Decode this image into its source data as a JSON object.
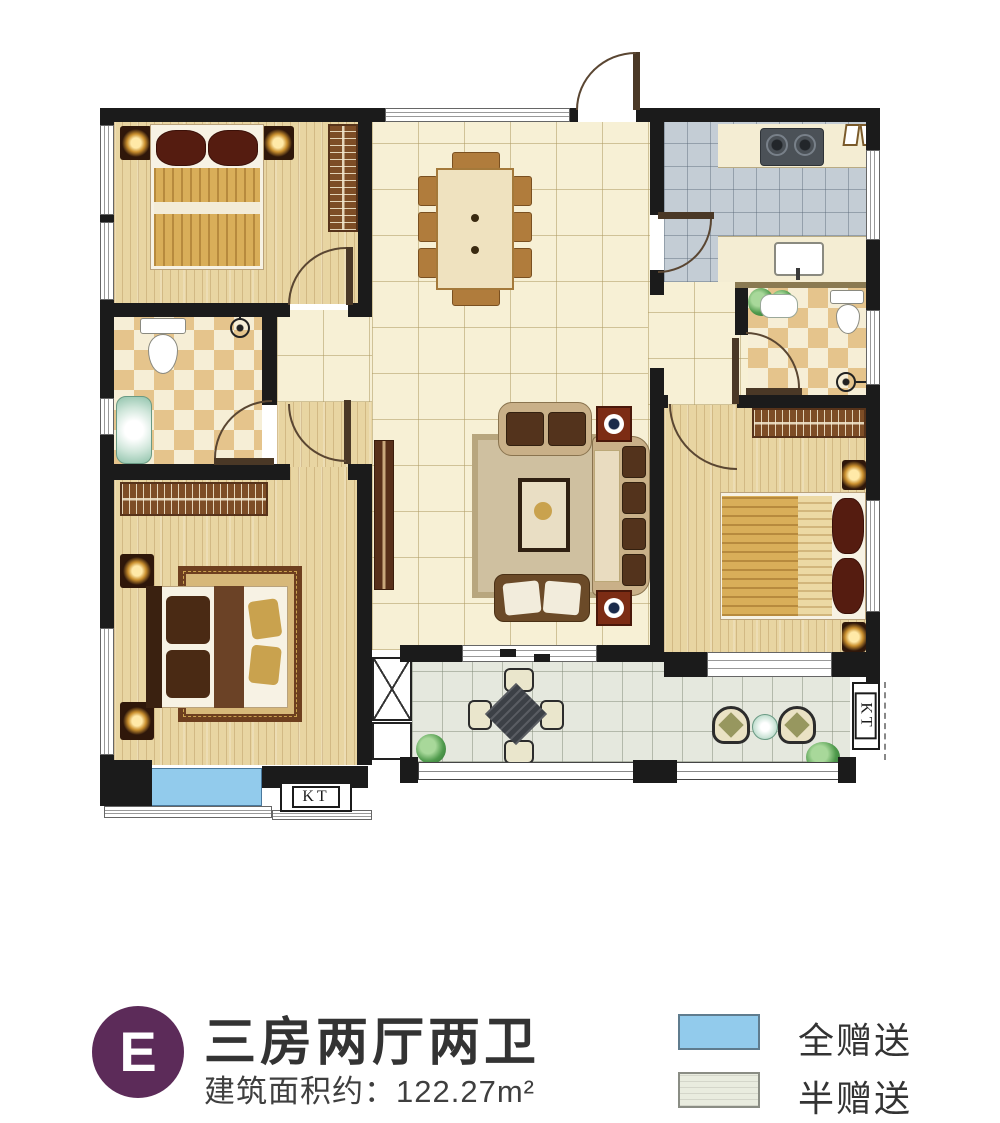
{
  "plan": {
    "ac_unit_label_left": "KT",
    "ac_unit_label_right": "KT",
    "rooms_visible": [
      "bedroom-top-left",
      "bathroom-left",
      "bedroom-bottom-left",
      "dining-area",
      "living-area",
      "kitchen",
      "bathroom-right",
      "bedroom-right",
      "balcony",
      "bay-window"
    ],
    "colors": {
      "wall": "#1b1b1b",
      "wood_floor": "#e8d5a2",
      "tile_floor": "#f7f0d5",
      "kitchen_tile": "#c4cdd5",
      "bath_checker": "#e5c48c",
      "balcony_tile": "#e5e8de",
      "gift_full_blue": "#92cbec",
      "gift_half_green": "#e9ecdf"
    }
  },
  "legend": {
    "unit_badge": "E",
    "badge_color": "#5c2b59",
    "title": "三房两厅两卫",
    "area_label": "建筑面积约：122.27m²",
    "items": [
      {
        "label": "全赠送",
        "color": "#92cbec"
      },
      {
        "label": "半赠送",
        "color": "#e9ecdf"
      }
    ]
  }
}
